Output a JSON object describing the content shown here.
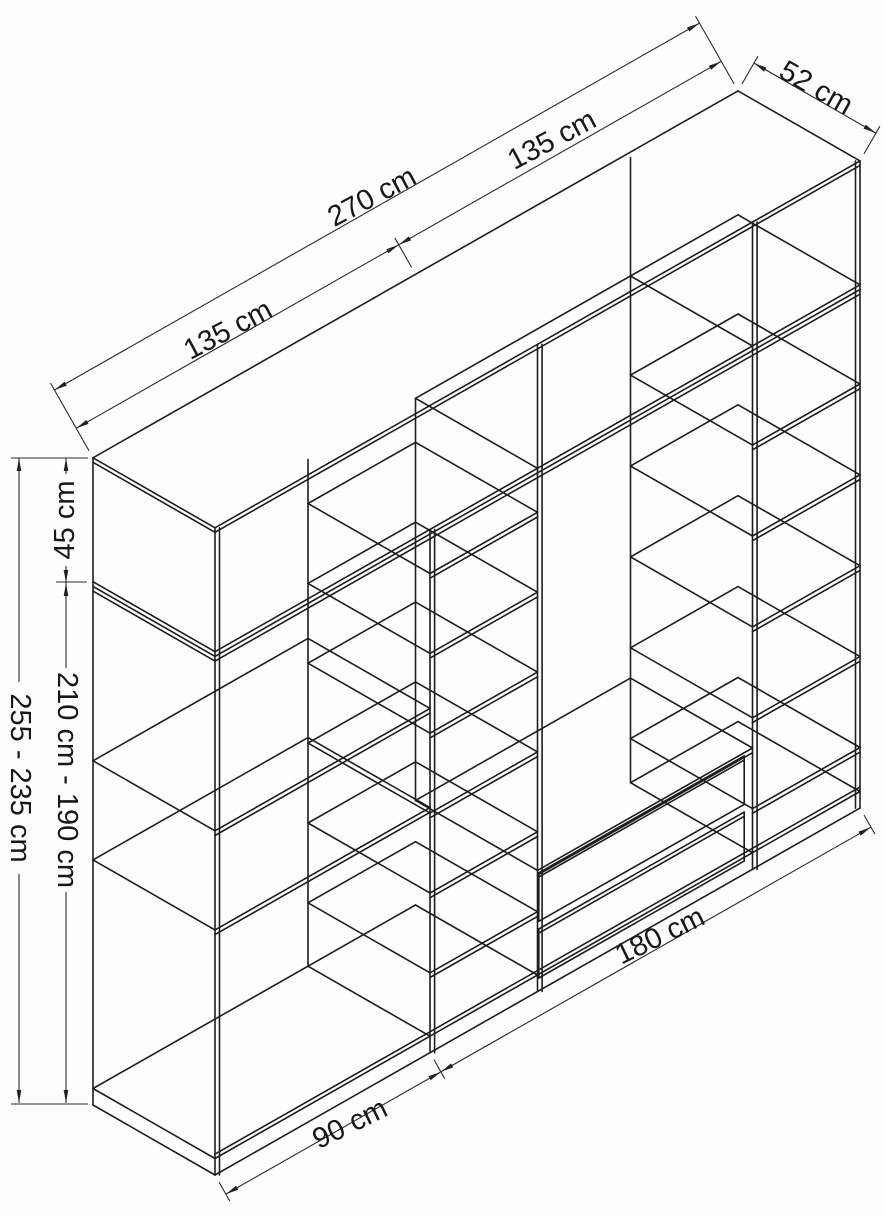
{
  "diagram": {
    "title": "wardrobe-isometric-technical-drawing",
    "unit": "cm",
    "colors": {
      "background": "#fefefe",
      "line": "#1d1d1d",
      "text": "#171717"
    },
    "dimensions": {
      "total_width": {
        "label": "270 cm",
        "value_cm": 270
      },
      "left_module_width": {
        "label": "135 cm",
        "value_cm": 135
      },
      "right_module_width": {
        "label": "135 cm",
        "value_cm": 135
      },
      "depth": {
        "label": "52 cm",
        "value_cm": 52
      },
      "top_section_height": {
        "label": "45 cm",
        "value_cm": 45
      },
      "body_height_range": {
        "label": "210 cm - 190 cm",
        "min_cm": 190,
        "max_cm": 210
      },
      "total_height_range": {
        "label": "255 - 235 cm",
        "min_cm": 235,
        "max_cm": 255
      },
      "base_left_width": {
        "label": "90 cm",
        "value_cm": 90
      },
      "base_right_width": {
        "label": "180 cm",
        "value_cm": 180
      }
    },
    "structure": {
      "total_width_cm": 270,
      "depth_cm": 52,
      "drawn_height_cm": 235,
      "plinth_cm": 6,
      "top_section": {
        "height_cm": 45,
        "dividers_at_cm": [
          135,
          225
        ],
        "open_front_from_cm": 135
      },
      "sections": [
        {
          "name": "left-shelf-column",
          "from_cm": 0,
          "to_cm": 90,
          "shelves_cm": [
            89,
            125
          ]
        },
        {
          "name": "middle-shelf-column",
          "from_cm": 90,
          "to_cm": 135,
          "shelves_cm": [
            29,
            58,
            87,
            116,
            145,
            174
          ]
        },
        {
          "name": "center-hanging-section",
          "from_cm": 135,
          "to_cm": 225,
          "platform_cm": 44,
          "drawer_count": 2
        },
        {
          "name": "right-shelf-column",
          "from_cm": 225,
          "to_cm": 270,
          "shelves_cm": [
            22,
            55,
            88,
            121,
            154
          ]
        }
      ]
    }
  }
}
